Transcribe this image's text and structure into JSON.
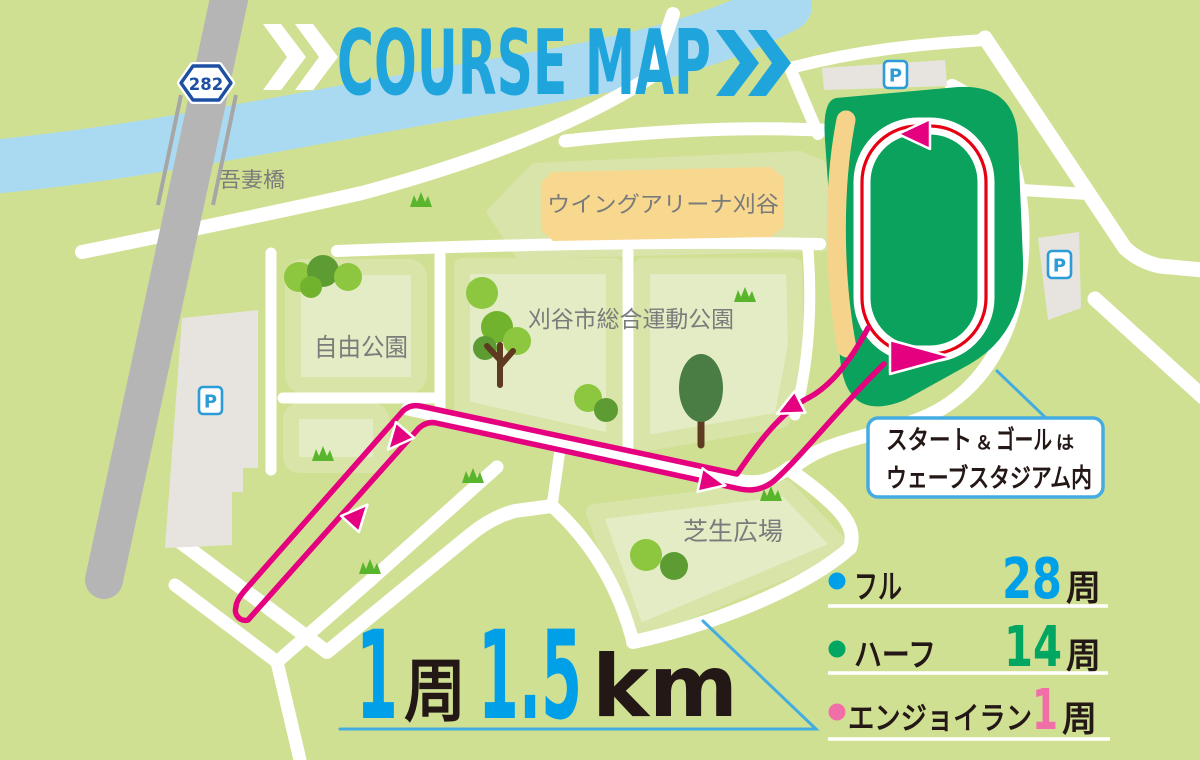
{
  "title": {
    "text": "COURSE MAP"
  },
  "map": {
    "route_badge": "282",
    "parking_letter": "P",
    "labels": {
      "bridge": "吾妻橋",
      "arena": "ウイングアリーナ刈谷",
      "jiyu_park": "自由公園",
      "sports_park": "刈谷市総合運動公園",
      "lawn_plaza": "芝生広場"
    },
    "callout": {
      "line1_main": "スタート",
      "line1_amp": "＆",
      "line1_main2": "ゴール",
      "line1_suffix": "は",
      "line2": "ウェーブスタジアム内"
    }
  },
  "lap_info": {
    "lap_num": "1",
    "lap_unit": "周",
    "distance": "1.5",
    "distance_unit": "km"
  },
  "legend": {
    "rows": [
      {
        "label": "フル",
        "laps": "28",
        "unit": "周",
        "color": "#00A0E9"
      },
      {
        "label": "ハーフ",
        "laps": "14",
        "unit": "周",
        "color": "#00A661"
      },
      {
        "label": "エンジョイラン",
        "laps": "1",
        "unit": "周",
        "color": "#F06FA8"
      }
    ]
  },
  "colors": {
    "background": "#D0E093",
    "park_block": "#E3ECC4",
    "river": "#A9DAF2",
    "road": "#FFFFFF",
    "highway": "#B5B5B6",
    "stadium_green": "#0AA25C",
    "grandstand": "#F6D38B",
    "track_line": "#E60012",
    "course_pink": "#E4007F",
    "title_blue": "#1FA5DC",
    "number_blue": "#00A0E9",
    "callout_border": "#45ACE1",
    "parking_blue": "#2B9CD8",
    "badge_blue": "#1D50A2"
  }
}
